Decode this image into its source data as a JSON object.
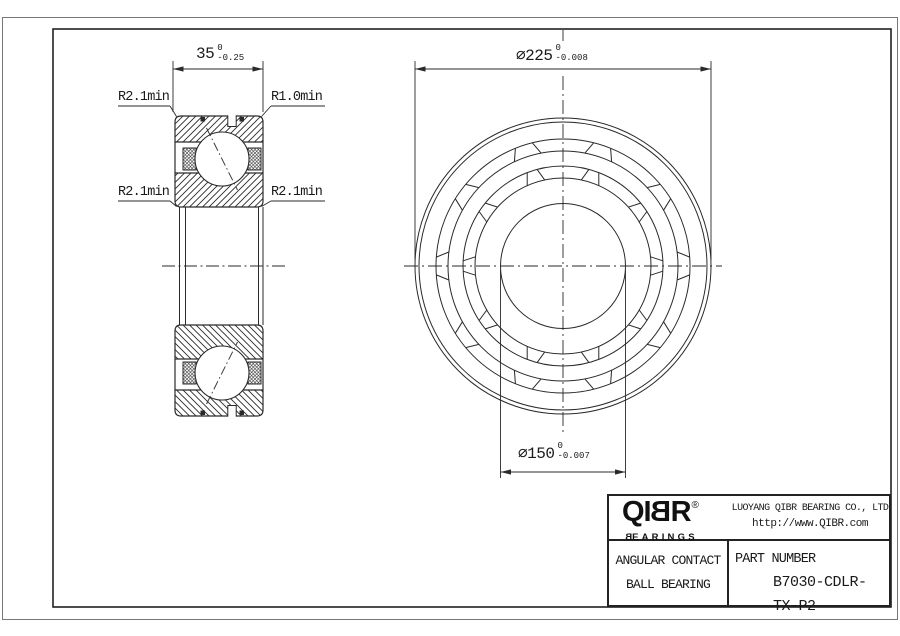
{
  "drawing": {
    "dims": {
      "width": {
        "value": "35",
        "tol_upper": "0",
        "tol_lower": "-0.25"
      },
      "outer_diameter": {
        "value": "⌀225",
        "tol_upper": "0",
        "tol_lower": "-0.008"
      },
      "bore_diameter": {
        "value": "⌀150",
        "tol_upper": "0",
        "tol_lower": "-0.007"
      }
    },
    "labels": {
      "fillet_top_left": "R2.1min",
      "fillet_top_right": "R1.0min",
      "fillet_mid_left": "R2.1min",
      "fillet_mid_right": "R2.1min"
    }
  },
  "title_block": {
    "logo": {
      "part1": "QI",
      "mirrored_b": "B",
      "part2": "R",
      "registered": "®"
    },
    "brand_sub": {
      "mirrored_b": "B",
      "rest": "EARINGS"
    },
    "company": "LUOYANG QIBR BEARING CO., LTD",
    "website": "http://www.QIBR.com",
    "product_line1": "ANGULAR CONTACT",
    "product_line2": "BALL BEARING",
    "part_label": "PART NUMBER",
    "part_number": "B7030-CDLR-TX-P2"
  },
  "colors": {
    "line": "#2a2a2a",
    "frame": "#222222",
    "page_edge": "#666666"
  }
}
